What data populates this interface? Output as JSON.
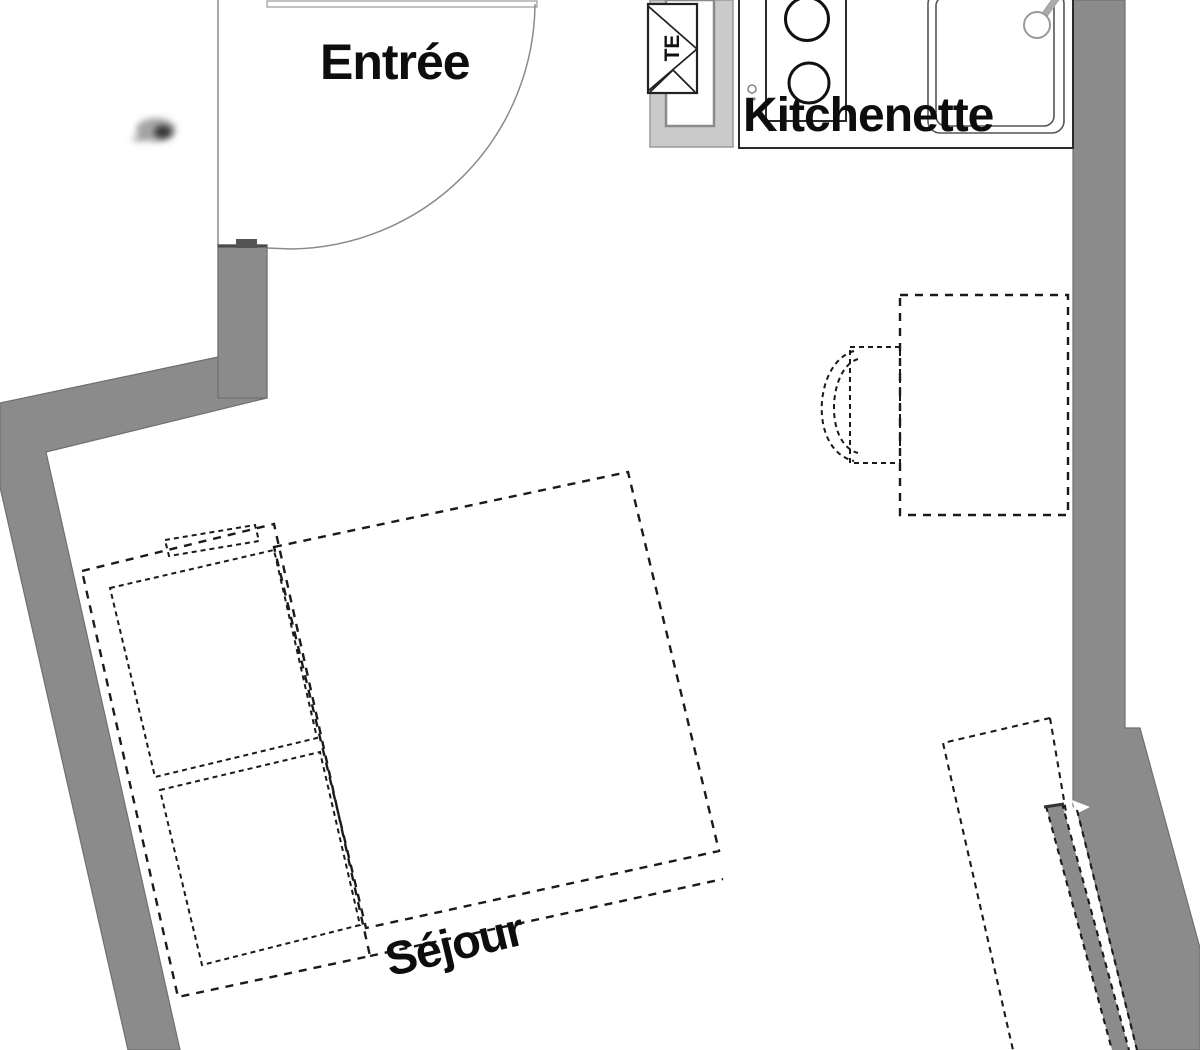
{
  "meta": {
    "drawing_type": "apartment floor plan"
  },
  "colors": {
    "wall": "#8b8b8b",
    "wall_edge": "#6f6f6f",
    "light_structure": "#cacaca",
    "line": "#1a1a1a",
    "thin_line": "#8a8a8a",
    "text": "#0d0d0d",
    "bg": "#ffffff"
  },
  "labels": {
    "entree": "Entrée",
    "kitchenette": "Kitchenette",
    "sejour": "Séjour",
    "electrical_panel": "TE"
  },
  "fixtures": {
    "stove_burner_count": 2,
    "items": [
      "entry-door-swing",
      "electrical-panel-te",
      "kitchen-counter",
      "stove-two-burners",
      "sink-with-faucet",
      "dining-table",
      "chair",
      "double-bed-with-two-pillows",
      "sliding-partition",
      "slanted-gray-walls"
    ]
  }
}
